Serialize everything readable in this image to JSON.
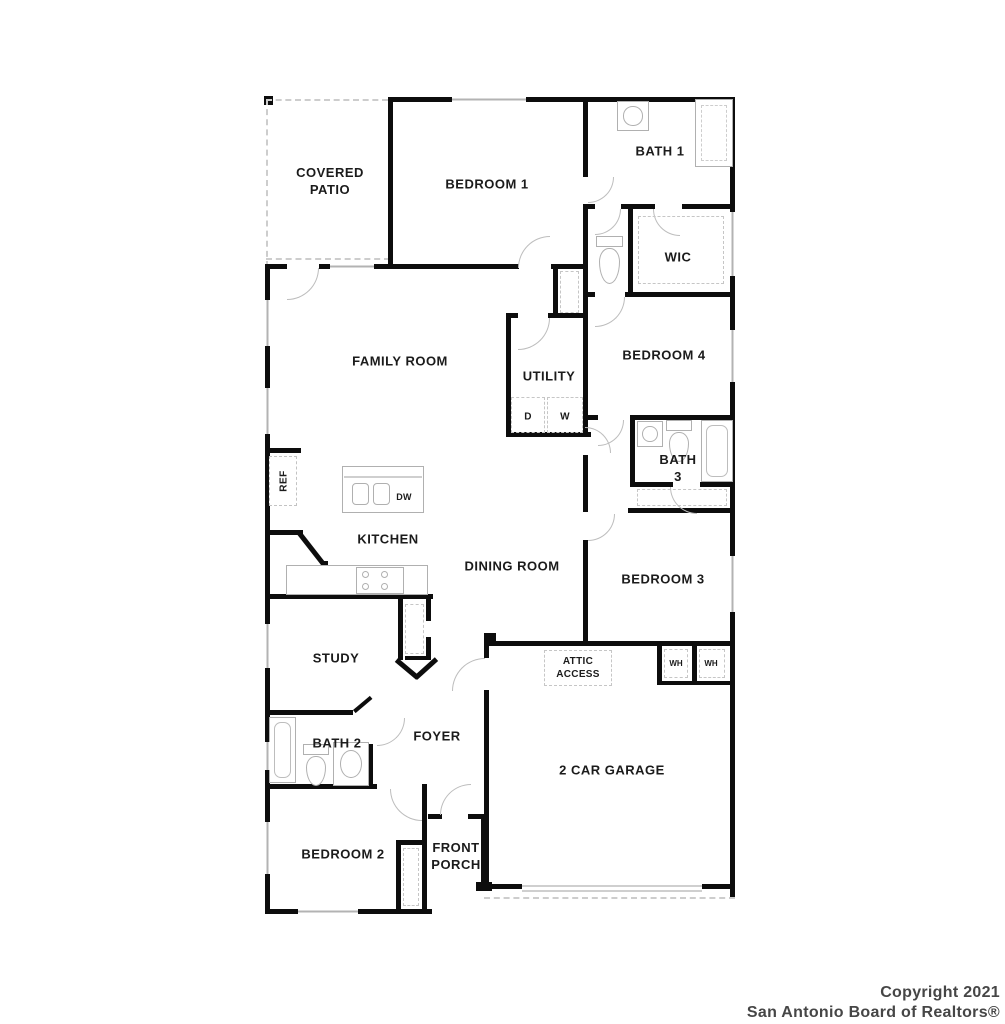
{
  "title": "Single-story house floor plan",
  "rooms": {
    "covered_patio": "COVERED\nPATIO",
    "bedroom1": "BEDROOM 1",
    "bath1": "BATH 1",
    "wic": "WIC",
    "family_room": "FAMILY ROOM",
    "utility": "UTILITY",
    "bedroom4": "BEDROOM 4",
    "bath3": "BATH\n3",
    "kitchen": "KITCHEN",
    "dining_room": "DINING ROOM",
    "bedroom3": "BEDROOM 3",
    "study": "STUDY",
    "bath2": "BATH 2",
    "foyer": "FOYER",
    "garage": "2 CAR GARAGE",
    "bedroom2": "BEDROOM 2",
    "front_porch": "FRONT\nPORCH"
  },
  "appliances": {
    "ref": "REF",
    "dw": "DW",
    "dryer": "D",
    "washer": "W",
    "wh_left": "WH",
    "wh_right": "WH"
  },
  "features": {
    "attic_access": "ATTIC\nACCESS"
  },
  "watermark": {
    "line1": "Copyright 2021",
    "line2": "San Antonio Board of Realtors®"
  },
  "colors": {
    "wall": "#0d0d0d",
    "fixture_gray": "#b0b0b0",
    "label_text": "#1b1b1b",
    "watermark_text": "#464646",
    "background": "#ffffff"
  }
}
